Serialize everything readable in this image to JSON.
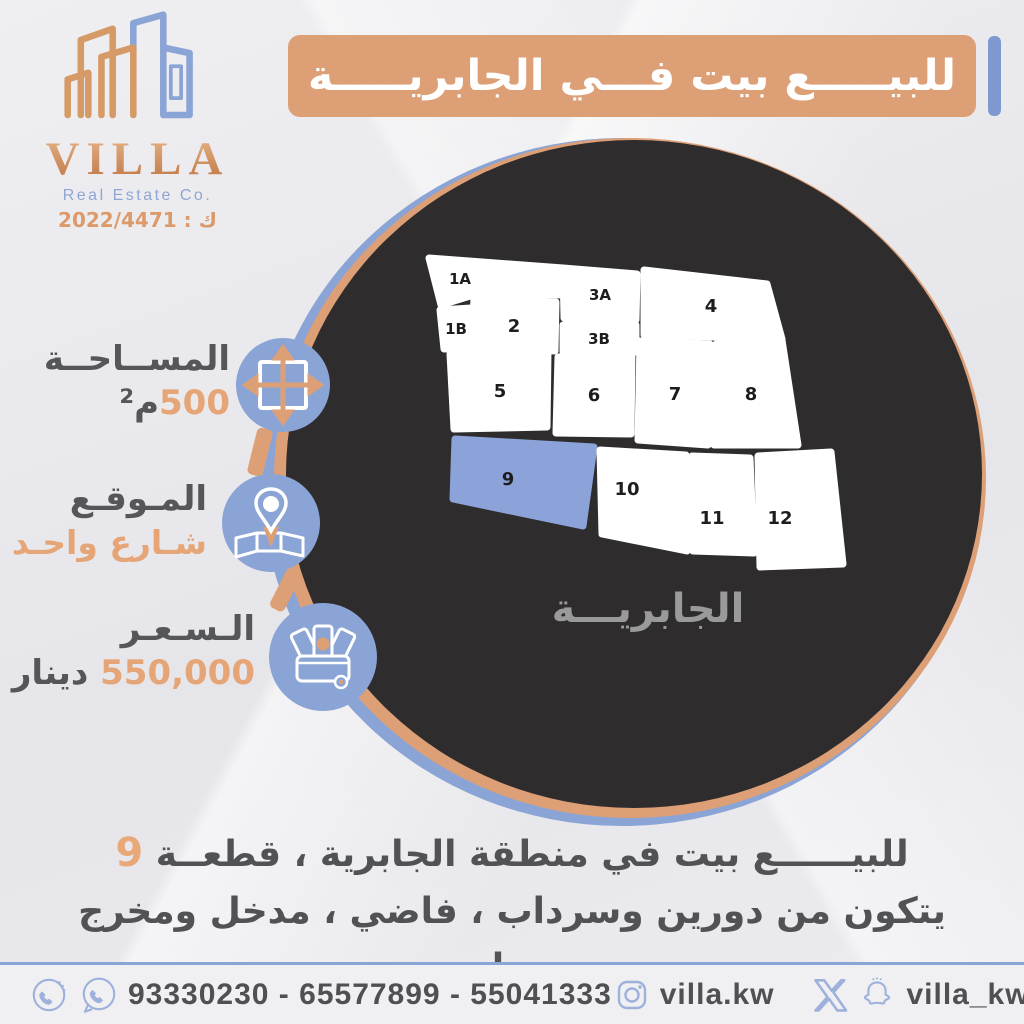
{
  "logo": {
    "name": "VILLA",
    "subtitle": "Real Estate Co.",
    "license": "ك : 2022/4471"
  },
  "banner": {
    "title": "للبيـــــع بيت فـــي الجابريـــــة"
  },
  "info": [
    {
      "id": "area",
      "title": "المســاحــة",
      "value": "500",
      "unit": "م²",
      "icon": "expand-arrows-icon"
    },
    {
      "id": "location",
      "title": "المـوقـع",
      "value": "شـارع واحـد",
      "unit": "",
      "icon": "location-pin-icon"
    },
    {
      "id": "price",
      "title": "الـسـعـر",
      "value": "550,000",
      "unit": "دينار",
      "icon": "money-wallet-icon"
    }
  ],
  "map": {
    "district_label": "الجابريـــة",
    "plot_color": "#ffffff",
    "highlight_color": "#8ba3d8",
    "highlighted_plot": "9",
    "plots": [
      {
        "label": "1A",
        "points": "14,21 148,31 146,58 65,56 26,68",
        "lx": 45,
        "ly": 47,
        "highlighted": false
      },
      {
        "label": "1B",
        "points": "25,73 56,71 54,111 29,112",
        "lx": 41,
        "ly": 97,
        "highlighted": false
      },
      {
        "label": "2",
        "points": "59,61 141,65 140,114 57,111",
        "lx": 99,
        "ly": 95,
        "highlighted": false
      },
      {
        "label": "3A",
        "points": "148,31 222,37 221,83 149,81",
        "lx": 185,
        "ly": 63,
        "highlighted": false
      },
      {
        "label": "3B",
        "points": "148,88 221,88 221,115 148,115",
        "lx": 184,
        "ly": 107,
        "highlighted": false
      },
      {
        "label": "4",
        "points": "229,33 352,47 367,102 229,98",
        "lx": 296,
        "ly": 75,
        "highlighted": false
      },
      {
        "label": "5",
        "points": "35,117 133,114 132,190 39,192",
        "lx": 85,
        "ly": 160,
        "highlighted": false
      },
      {
        "label": "6",
        "points": "143,120 217,118 216,197 141,196",
        "lx": 179,
        "ly": 164,
        "highlighted": false
      },
      {
        "label": "7",
        "points": "225,104 295,107 293,208 223,203",
        "lx": 260,
        "ly": 163,
        "highlighted": false
      },
      {
        "label": "8",
        "points": "301,107 367,103 383,208 299,208",
        "lx": 336,
        "ly": 163,
        "highlighted": false
      },
      {
        "label": "9",
        "points": "40,202 179,210 168,289 38,262",
        "lx": 93,
        "ly": 248,
        "highlighted": true
      },
      {
        "label": "10",
        "points": "185,213 271,218 272,314 187,297",
        "lx": 212,
        "ly": 258,
        "highlighted": false
      },
      {
        "label": "11",
        "points": "277,219 335,221 339,316 278,314",
        "lx": 297,
        "ly": 287,
        "highlighted": false
      },
      {
        "label": "12",
        "points": "343,219 416,215 428,327 345,330",
        "lx": 365,
        "ly": 287,
        "highlighted": false
      }
    ]
  },
  "description": {
    "line1": "للبيــــــع بيت في منطقة الجابرية ، قطعــة ",
    "line1_highlight": "9",
    "line2": "يتكون من دورين وسرداب ، فاضي ، مدخل ومخرج سهل."
  },
  "footer": {
    "phones": "93330230 - 65577899 - 55041333",
    "instagram_handle": "villa.kw",
    "social_handle": "villa_kw"
  },
  "colors": {
    "orange": "#dd9f76",
    "blue": "#8ba4d6",
    "dark_ellipse": "#2e2c2d",
    "text_dark": "#55565a",
    "text_orange": "#e5a577",
    "plot_highlight": "#8ba3d8",
    "map_label_gray": "#9a9a9a"
  }
}
